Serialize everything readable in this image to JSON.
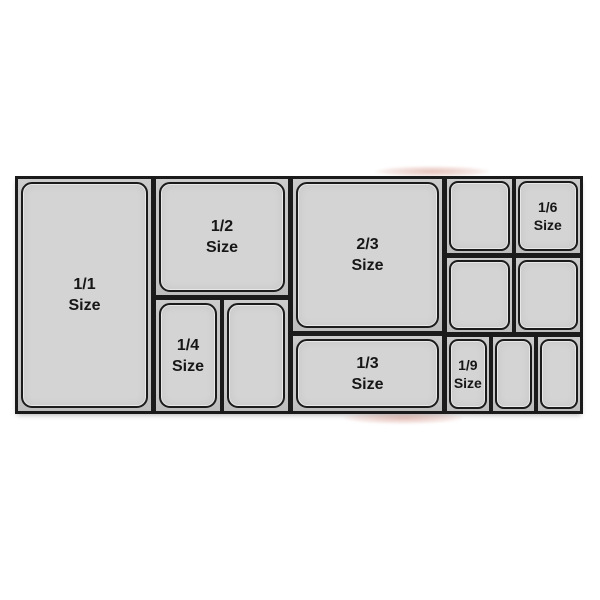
{
  "colors": {
    "page_bg": "#ffffff",
    "frame": "#1b1b1b",
    "cell": "#c6c6c6",
    "pan": "#d4d4d4",
    "text": "#161616",
    "smudge": "#cd8273"
  },
  "pans": {
    "full": {
      "fraction": "1/1",
      "word": "Size"
    },
    "half": {
      "fraction": "1/2",
      "word": "Size"
    },
    "two_thirds": {
      "fraction": "2/3",
      "word": "Size"
    },
    "quarter": {
      "fraction": "1/4",
      "word": "Size"
    },
    "third": {
      "fraction": "1/3",
      "word": "Size"
    },
    "sixth": {
      "fraction": "1/6",
      "word": "Size"
    },
    "ninth": {
      "fraction": "1/9",
      "word": "Size"
    }
  }
}
